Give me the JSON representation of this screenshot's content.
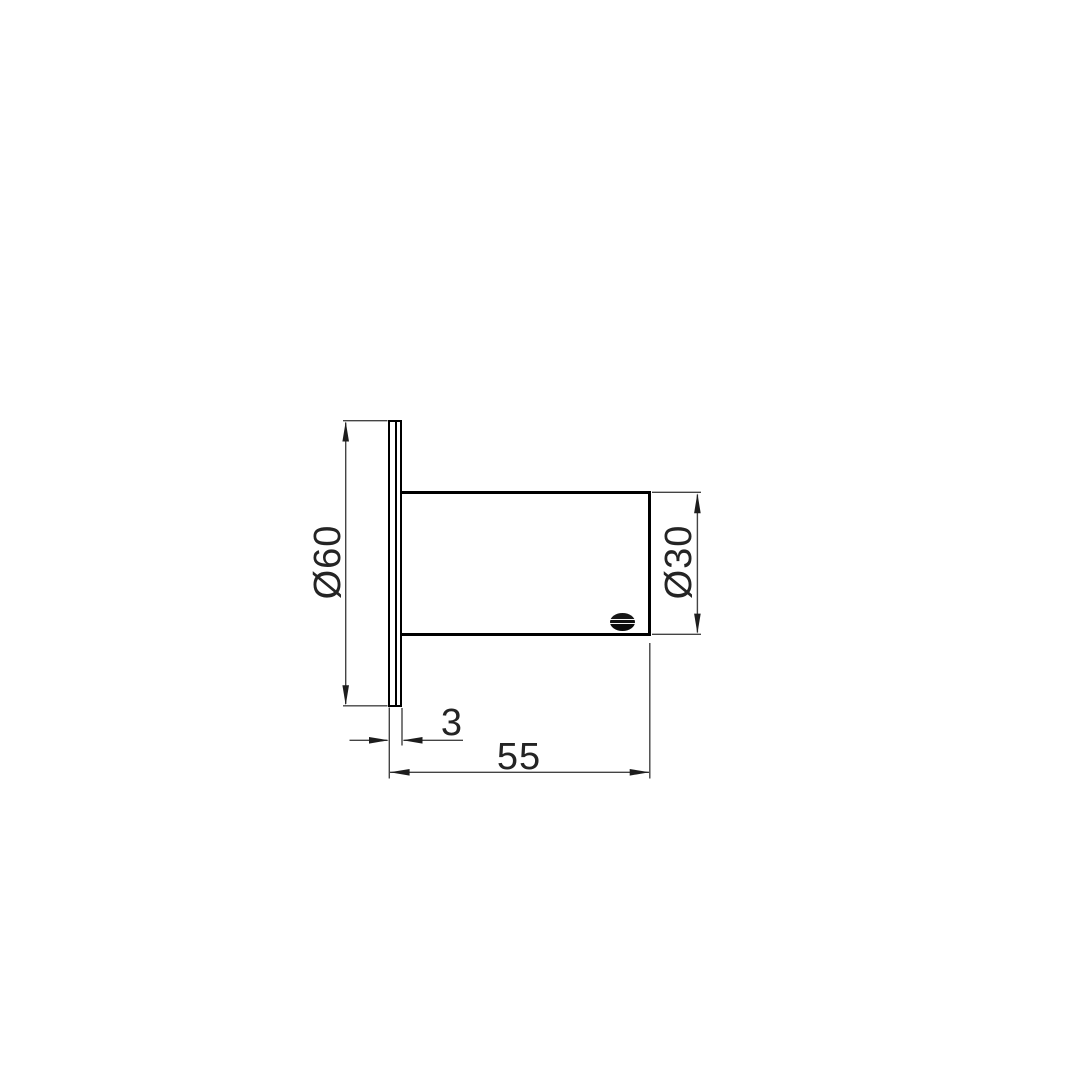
{
  "drawing": {
    "kind": "technical-dimension-drawing",
    "object": "wall-mounted cylindrical fixture, side elevation",
    "line_color": "#000000",
    "dimension_line_color": "#444444",
    "background_color": "#ffffff",
    "logo": "manufacturer-logo-ellipse"
  },
  "dimensions": {
    "flange_diameter": "Ø60",
    "body_diameter": "Ø30",
    "flange_thickness": "3",
    "overall_depth": "55"
  }
}
